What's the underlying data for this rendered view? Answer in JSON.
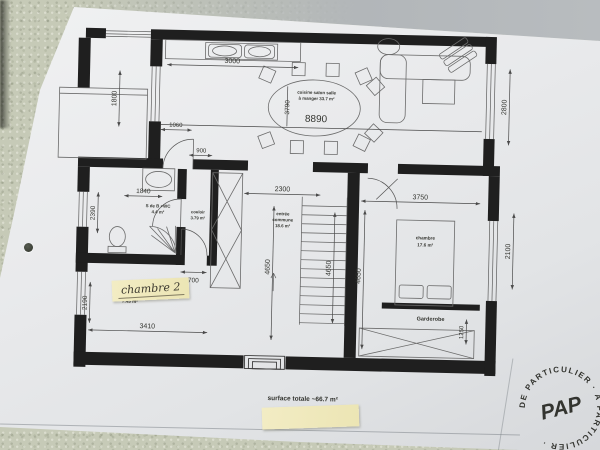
{
  "plan": {
    "rooms": {
      "living": {
        "line1": "cuisine salon salle",
        "line2": "à manger 33.7 m²",
        "length_label": "8890",
        "width_label": "3790"
      },
      "bathroom": {
        "line1": "S de B +WC",
        "line2": "4.4 m²"
      },
      "corridor": {
        "line1": "couloir",
        "line2": "3.79 m²"
      },
      "entry": {
        "line1": "entrée",
        "line2": "commune",
        "line3": "18.6 m²"
      },
      "bedroom2": {
        "note": "chambre 2",
        "area": "7.45 m²"
      },
      "bedroom1": {
        "line1": "chambre",
        "line2": "17.6 m²",
        "wardrobe": "Garderobe"
      }
    },
    "dims": {
      "kitchen_width": "3000",
      "balcony_window": "1800",
      "living_door": "1060",
      "corridor_width": "900",
      "bath_width": "1840",
      "bath_height": "2390",
      "bedroom2_height": "2190",
      "bedroom2_width": "3410",
      "bedroom2_door": "700",
      "entry_width": "2300",
      "entry_height": "4650",
      "stair_height": "4650",
      "bedroom1_height": "4650",
      "bedroom1_width": "3750",
      "living_window": "2800",
      "bedroom1_window": "2100",
      "wardrobe_depth": "1250"
    },
    "total_area": "surface totale ~66.7 m²"
  },
  "watermark": {
    "center": "PAP",
    "ring": "DE PARTICULIER · À PARTICULIER · "
  }
}
